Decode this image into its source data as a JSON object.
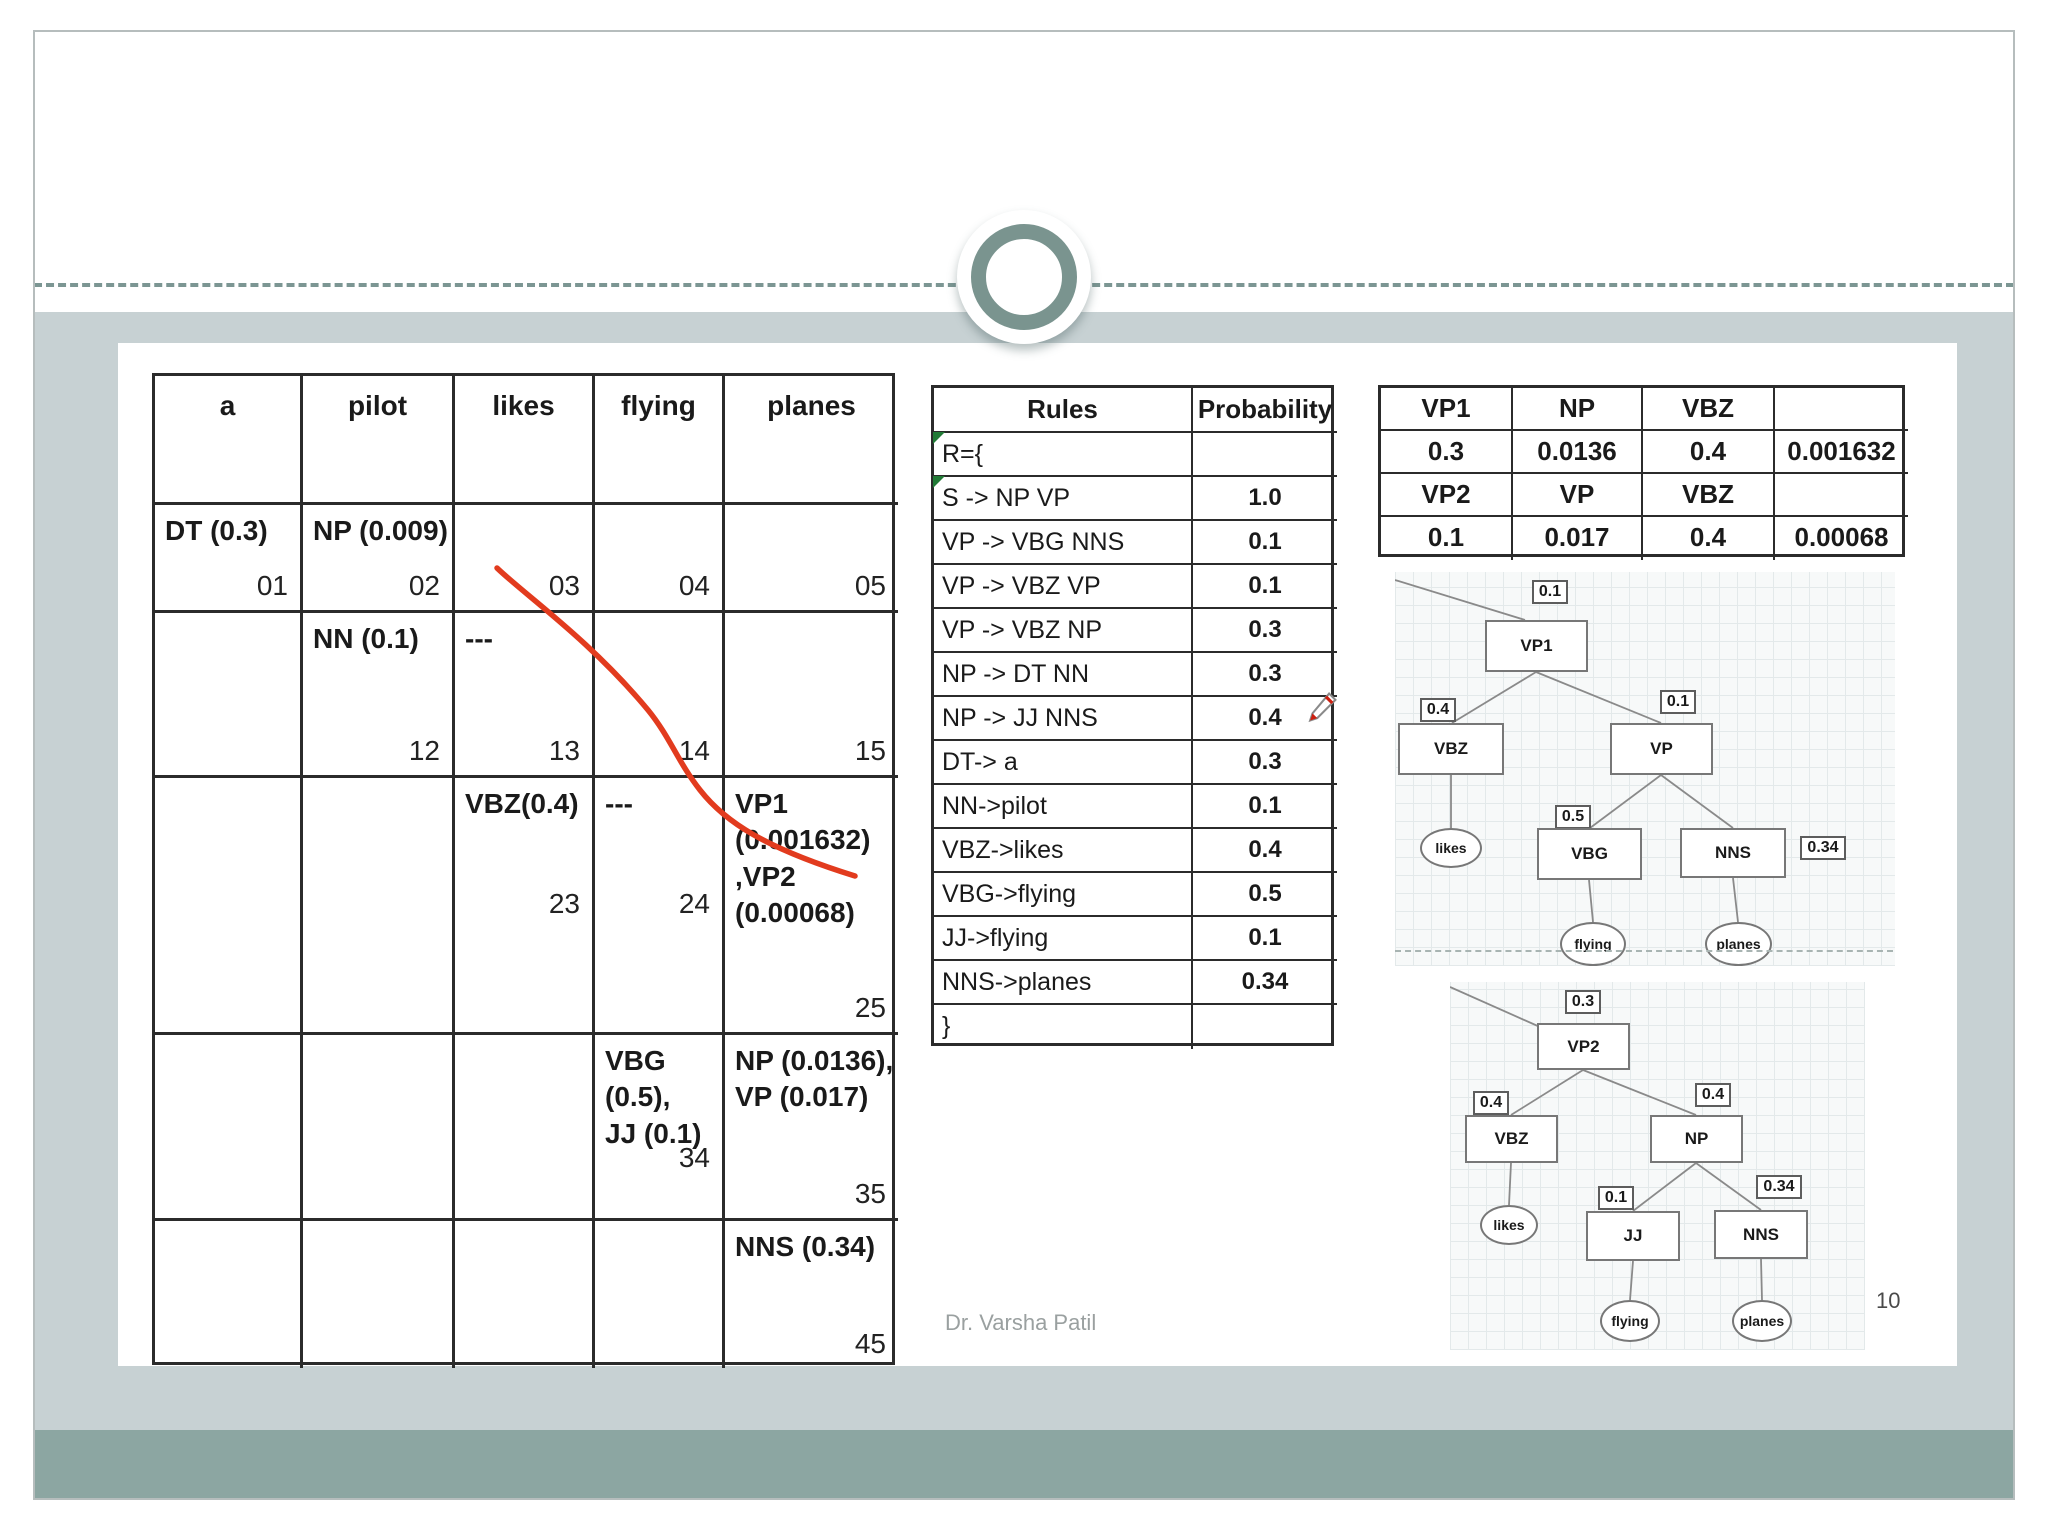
{
  "slide": {
    "footer": "Dr. Varsha Patil",
    "page_number": "10"
  },
  "colors": {
    "band_light": "#c7d1d3",
    "band_dark": "#8ca6a2",
    "ring_teal": "#7a948f",
    "table_border": "#2b2b2b",
    "red_annotation": "#e23b1e",
    "green_marker": "#217a36"
  },
  "cyk_table": {
    "headers": [
      "a",
      "pilot",
      "likes",
      "flying",
      "planes"
    ],
    "rows": [
      [
        {
          "tag": "DT (0.3)",
          "idx": "01"
        },
        {
          "tag": "NP (0.009)",
          "idx": "02"
        },
        {
          "tag": "",
          "idx": "03"
        },
        {
          "tag": "",
          "idx": "04"
        },
        {
          "tag": "",
          "idx": "05"
        }
      ],
      [
        {
          "tag": "",
          "idx": ""
        },
        {
          "tag": "NN (0.1)",
          "idx": "12"
        },
        {
          "tag": "---",
          "idx": "13"
        },
        {
          "tag": "",
          "idx": "14"
        },
        {
          "tag": "",
          "idx": "15"
        }
      ],
      [
        {
          "tag": "",
          "idx": ""
        },
        {
          "tag": "",
          "idx": ""
        },
        {
          "tag": "VBZ(0.4)",
          "idx": "23"
        },
        {
          "tag": "---",
          "idx": "24"
        },
        {
          "tag": "VP1\n(0.001632)\n,VP2\n(0.00068)",
          "idx": "25"
        }
      ],
      [
        {
          "tag": "",
          "idx": ""
        },
        {
          "tag": "",
          "idx": ""
        },
        {
          "tag": "",
          "idx": ""
        },
        {
          "tag": "VBG (0.5),\nJJ (0.1)",
          "idx": "34"
        },
        {
          "tag": "NP (0.0136),\nVP (0.017)",
          "idx": "35"
        }
      ],
      [
        {
          "tag": "",
          "idx": ""
        },
        {
          "tag": "",
          "idx": ""
        },
        {
          "tag": "",
          "idx": ""
        },
        {
          "tag": "",
          "idx": ""
        },
        {
          "tag": "NNS (0.34)",
          "idx": "45"
        }
      ]
    ]
  },
  "rules_table": {
    "headers": [
      "Rules",
      "Probability"
    ],
    "rows": [
      {
        "rule": "R={",
        "prob": ""
      },
      {
        "rule": "S -> NP VP",
        "prob": "1.0"
      },
      {
        "rule": "VP -> VBG NNS",
        "prob": "0.1"
      },
      {
        "rule": "VP -> VBZ VP",
        "prob": "0.1"
      },
      {
        "rule": "VP -> VBZ NP",
        "prob": "0.3"
      },
      {
        "rule": "NP -> DT NN",
        "prob": "0.3"
      },
      {
        "rule": "NP -> JJ NNS",
        "prob": "0.4"
      },
      {
        "rule": "DT-> a",
        "prob": "0.3"
      },
      {
        "rule": "NN->pilot",
        "prob": "0.1"
      },
      {
        "rule": "VBZ->likes",
        "prob": "0.4"
      },
      {
        "rule": "VBG->flying",
        "prob": "0.5"
      },
      {
        "rule": "JJ->flying",
        "prob": "0.1"
      },
      {
        "rule": "NNS->planes",
        "prob": "0.34"
      },
      {
        "rule": "}",
        "prob": ""
      }
    ]
  },
  "summary_table": {
    "rows": [
      [
        "VP1",
        "NP",
        "VBZ",
        ""
      ],
      [
        "0.3",
        "0.0136",
        "0.4",
        "0.001632"
      ],
      [
        "VP2",
        "VP",
        "VBZ",
        ""
      ],
      [
        "0.1",
        "0.017",
        "0.4",
        "0.00068"
      ]
    ]
  },
  "tree_vp1": {
    "root_prob": "0.1",
    "root": "VP1",
    "left_prob": "0.4",
    "left": "VBZ",
    "left_word": "likes",
    "right_prob": "0.1",
    "right": "VP",
    "grand_left_prob": "0.5",
    "grand_left": "VBG",
    "grand_left_word": "flying",
    "grand_right": "NNS",
    "grand_right_prob": "0.34",
    "grand_right_word": "planes"
  },
  "tree_vp2": {
    "root_prob": "0.3",
    "root": "VP2",
    "left_prob": "0.4",
    "left": "VBZ",
    "left_word": "likes",
    "right_prob": "0.4",
    "right": "NP",
    "grand_left_prob": "0.1",
    "grand_left": "JJ",
    "grand_left_word": "flying",
    "grand_right": "NNS",
    "grand_right_prob": "0.34",
    "grand_right_word": "planes"
  }
}
